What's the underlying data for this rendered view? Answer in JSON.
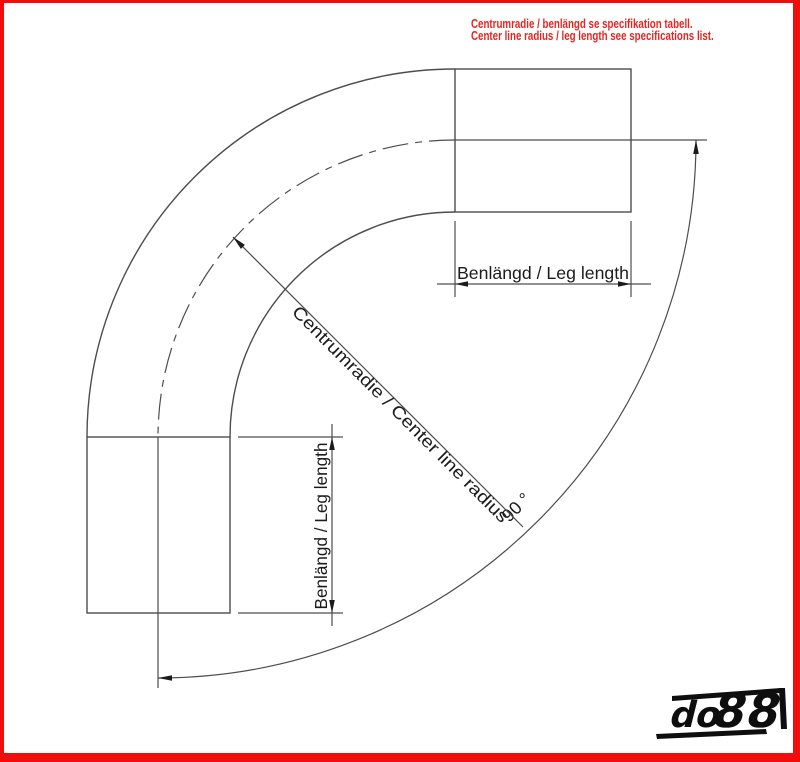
{
  "note": {
    "line1": "Centrumradie / benlängd se specifikation tabell.",
    "line2": "Center line radius / leg length see specifications list."
  },
  "drawing": {
    "bend_angle_label": "90 °",
    "radius_label": "Centrumradie / Center line radius",
    "leg_length_top_label": "Benlängd / Leg length",
    "leg_length_left_label": "Benlängd / Leg length"
  },
  "logo": {
    "prefix": "do",
    "suffix": "88"
  },
  "colors": {
    "frame_red": "#f20d0d",
    "note_red": "#e42623",
    "line": "#4d4d4d",
    "ink": "#1c1c1c",
    "logo_black": "#0e0e0e"
  }
}
